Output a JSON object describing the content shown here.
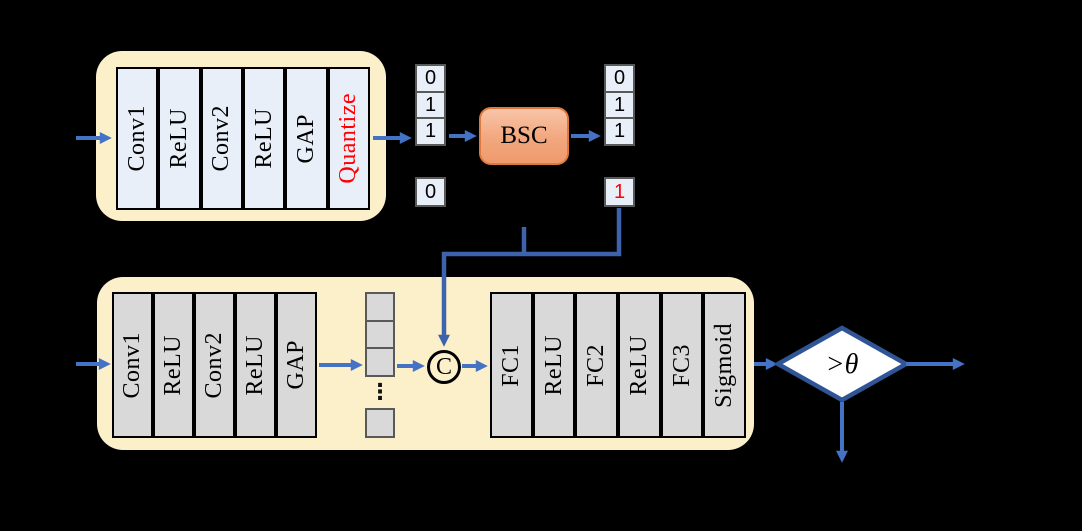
{
  "colors": {
    "background": "#000000",
    "panel_fill": "#FCF0CB",
    "top_block_fill": "#E9EFF9",
    "bottom_block_fill": "#D9D9D9",
    "arrow_blue": "#4472C4",
    "connector_blue": "#3C63AC",
    "diamond_border": "#2F5597",
    "bsc_fill": "#F2A77E",
    "bsc_border": "#E0793E",
    "highlight_red": "#FF0000"
  },
  "top_branch": {
    "blocks": [
      "Conv1",
      "ReLU",
      "Conv2",
      "ReLU",
      "GAP",
      "Quantize"
    ],
    "input_bits": [
      "0",
      "1",
      "1"
    ],
    "input_extra_bit": "0",
    "channel": "BSC",
    "output_bits": [
      "0",
      "1",
      "1"
    ],
    "flipped_bit": "1"
  },
  "bottom_branch": {
    "blocks": [
      "Conv1",
      "ReLU",
      "Conv2",
      "ReLU",
      "GAP"
    ],
    "feature_dots": "⋮",
    "concat": "C",
    "head_blocks": [
      "FC1",
      "ReLU",
      "FC2",
      "ReLU",
      "FC3",
      "Sigmoid"
    ],
    "decision": ">θ"
  }
}
